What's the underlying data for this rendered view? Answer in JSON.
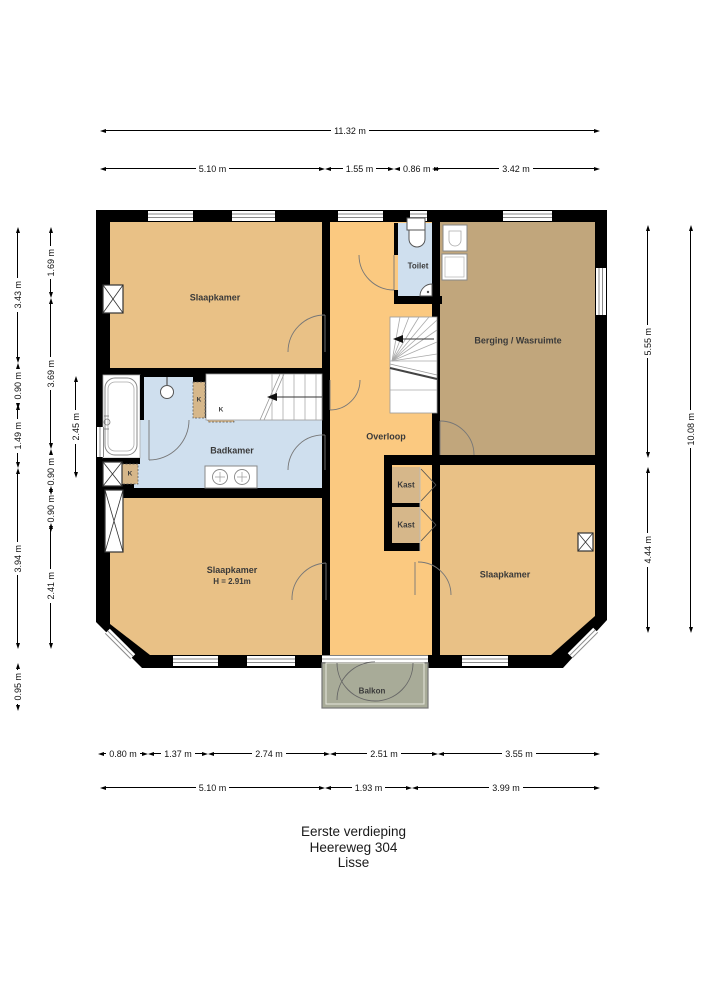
{
  "title": {
    "building_level": "Eerste verdieping",
    "street": "Heereweg 304",
    "city": "Lisse"
  },
  "rooms": {
    "bedroom_tl": "Slaapkamer",
    "toilet": "Toilet",
    "storage": "Berging / Wasruimte",
    "landing": "Overloop",
    "bathroom": "Badkamer",
    "closet_a": "Kast",
    "closet_b": "Kast",
    "bedroom_bl": "Slaapkamer",
    "bedroom_bl_height": "H = 2.91m",
    "bedroom_br": "Slaapkamer",
    "balcony": "Balkon",
    "k": "K"
  },
  "dims": {
    "overall_width": "11.32 m",
    "top": [
      "5.10 m",
      "1.55 m",
      "0.86 m",
      "3.42 m"
    ],
    "bottom_detail": [
      "0.80 m",
      "1.37 m",
      "2.74 m",
      "2.51 m",
      "3.55 m"
    ],
    "bottom_main": [
      "5.10 m",
      "1.93 m",
      "3.99 m"
    ],
    "left_outer": [
      "3.43 m",
      "0.90 m",
      "1.49 m",
      "3.94 m",
      "0.95 m"
    ],
    "left_inner": [
      "1.69 m",
      "3.69 m",
      "0.90 m",
      "0.90 m",
      "2.41 m"
    ],
    "left_detail": "2.45 m",
    "right_inner": [
      "5.55 m",
      "4.44 m"
    ],
    "right_outer": "10.08 m"
  },
  "colors": {
    "wall": "#000000",
    "bedroom": "#e9c186",
    "landing": "#fbc980",
    "storage": "#c1a67c",
    "bathroom": "#cfdfee",
    "closet": "#d6b78a",
    "balcony": "#a8ab98",
    "stair": "#ffffff",
    "fixture": "#ffffff"
  }
}
